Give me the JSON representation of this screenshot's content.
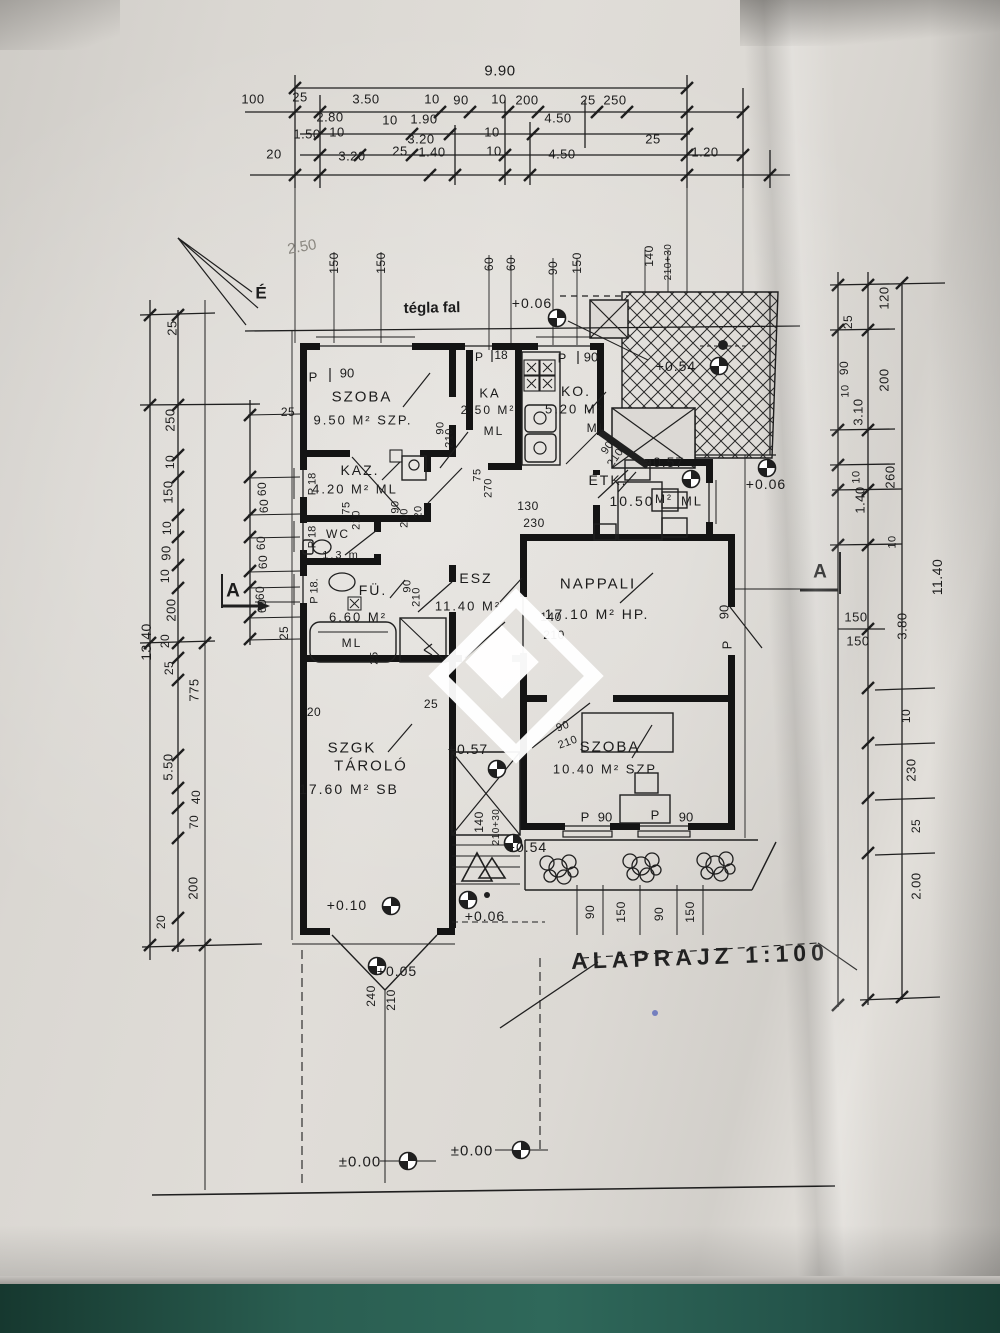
{
  "document": {
    "type": "architectural floor plan photo",
    "title": "ALAPRAJZ  1:100",
    "scale": "1:100",
    "north_label": "É",
    "wall_note": "tégla fal",
    "pencil_note": "2.50",
    "section_marker_left": "A",
    "section_marker_right": "A"
  },
  "rooms": [
    {
      "name": "SZOBA",
      "area": "9.50 M²",
      "suffix": "SZP."
    },
    {
      "name": "KAZ.",
      "area": "4.20 M²",
      "suffix": "ML"
    },
    {
      "name": "KA",
      "area": "2.50 M²",
      "suffix": "ML"
    },
    {
      "name": "KO.",
      "area": "5.20 M²",
      "suffix": "ML"
    },
    {
      "name": "ÉTK.",
      "area": "10.50 M²",
      "suffix": "ML"
    },
    {
      "name": "WC",
      "area": "1.3 m",
      "suffix": ""
    },
    {
      "name": "FÜ.",
      "area": "6.60 M²",
      "suffix": "ML"
    },
    {
      "name": "ESZ",
      "area": "11.40 M²",
      "suffix": ""
    },
    {
      "name": "NAPPALI",
      "area": "17.10 M²",
      "suffix": "HP."
    },
    {
      "name": "SZOBA",
      "area": "10.40 M²",
      "suffix": "SZP"
    },
    {
      "name": "SZGK TÁROLÓ",
      "area": "17.60 M²",
      "suffix": "SB"
    }
  ],
  "elevation_marks": [
    "+0.06",
    "+0.54",
    "+0.57",
    "+0.06",
    "+0.57",
    "+0.54",
    "+0.10",
    "+0.06",
    "+0.05",
    "±0.00",
    "±0.00"
  ],
  "totals": {
    "top": "9.90",
    "left": "13.40",
    "right": "11.40"
  },
  "annotations": [
    [
      "9.90",
      500,
      71,
      0,
      15,
      "d"
    ],
    [
      "100",
      253,
      99,
      0,
      13,
      "d"
    ],
    [
      "25",
      300,
      97,
      0,
      13,
      "d"
    ],
    [
      "3.50",
      366,
      99,
      0,
      13,
      "d"
    ],
    [
      "10",
      432,
      99,
      0,
      13,
      "d"
    ],
    [
      "90",
      461,
      100,
      0,
      13,
      "d"
    ],
    [
      "10",
      499,
      99,
      0,
      13,
      "d"
    ],
    [
      "200",
      527,
      100,
      0,
      13,
      "d"
    ],
    [
      "25",
      588,
      100,
      0,
      13,
      "d"
    ],
    [
      "250",
      615,
      100,
      0,
      13,
      "d"
    ],
    [
      "2.80",
      330,
      117,
      0,
      13,
      "d"
    ],
    [
      "10",
      390,
      120,
      0,
      13,
      "d"
    ],
    [
      "1.90",
      424,
      119,
      0,
      13,
      "d"
    ],
    [
      "4.50",
      558,
      118,
      0,
      13,
      "d"
    ],
    [
      "1.50",
      307,
      134,
      0,
      13,
      "d"
    ],
    [
      "10",
      337,
      132,
      0,
      13,
      "d"
    ],
    [
      "3.20",
      421,
      139,
      0,
      13,
      "d"
    ],
    [
      "10",
      492,
      132,
      0,
      13,
      "d"
    ],
    [
      "25",
      653,
      139,
      0,
      13,
      "d"
    ],
    [
      "20",
      274,
      154,
      0,
      13,
      "d"
    ],
    [
      "3.20",
      352,
      156,
      0,
      13,
      "d"
    ],
    [
      "25",
      400,
      151,
      0,
      13,
      "d"
    ],
    [
      "1.40",
      432,
      152,
      0,
      13,
      "d"
    ],
    [
      "10",
      494,
      151,
      0,
      13,
      "d"
    ],
    [
      "4.50",
      562,
      154,
      0,
      13,
      "d"
    ],
    [
      "1.20",
      705,
      152,
      0,
      13,
      "d"
    ],
    [
      "150",
      334,
      263,
      -90,
      12,
      "d"
    ],
    [
      "150",
      381,
      263,
      -90,
      12,
      "d"
    ],
    [
      "60",
      489,
      264,
      -90,
      12,
      "d"
    ],
    [
      "60",
      511,
      264,
      -90,
      12,
      "d"
    ],
    [
      "90",
      553,
      268,
      -90,
      12,
      "d"
    ],
    [
      "150",
      577,
      263,
      -90,
      12,
      "d"
    ],
    [
      "140",
      649,
      256,
      -90,
      12,
      "d"
    ],
    [
      "210+30",
      669,
      262,
      -90,
      10,
      "d"
    ],
    [
      "2.50",
      302,
      247,
      -10,
      15,
      "p"
    ],
    [
      "25",
      172,
      328,
      -90,
      13,
      "d"
    ],
    [
      "250",
      170,
      420,
      -90,
      13,
      "d"
    ],
    [
      "10",
      170,
      462,
      -90,
      12,
      "d"
    ],
    [
      "150",
      168,
      492,
      -90,
      13,
      "d"
    ],
    [
      "10",
      167,
      528,
      -90,
      12,
      "d"
    ],
    [
      "90",
      166,
      553,
      -90,
      13,
      "d"
    ],
    [
      "10",
      165,
      576,
      -90,
      12,
      "d"
    ],
    [
      "200",
      171,
      610,
      -90,
      13,
      "d"
    ],
    [
      "20",
      165,
      641,
      -90,
      12,
      "d"
    ],
    [
      "25",
      169,
      668,
      -90,
      12,
      "d"
    ],
    [
      "775",
      194,
      690,
      -90,
      13,
      "d"
    ],
    [
      "5.50",
      168,
      767,
      -90,
      13,
      "d"
    ],
    [
      "40",
      196,
      797,
      -90,
      12,
      "d"
    ],
    [
      "70",
      194,
      822,
      -90,
      12,
      "d"
    ],
    [
      "200",
      193,
      888,
      -90,
      13,
      "d"
    ],
    [
      "20",
      161,
      922,
      -90,
      12,
      "d"
    ],
    [
      "13.40",
      146,
      642,
      -90,
      14,
      "d"
    ],
    [
      "25",
      288,
      412,
      0,
      12,
      "d"
    ],
    [
      "60",
      262,
      489,
      -90,
      12,
      "d"
    ],
    [
      "60",
      264,
      506,
      -90,
      12,
      "d"
    ],
    [
      "60",
      261,
      543,
      -90,
      12,
      "d"
    ],
    [
      "60",
      263,
      562,
      -90,
      12,
      "d"
    ],
    [
      "60",
      260,
      593,
      -90,
      12,
      "d"
    ],
    [
      "60",
      262,
      606,
      -90,
      12,
      "d"
    ],
    [
      "25",
      284,
      633,
      -90,
      12,
      "d"
    ],
    [
      "120",
      884,
      298,
      -90,
      13,
      "d"
    ],
    [
      "25",
      848,
      322,
      -90,
      12,
      "d"
    ],
    [
      "200",
      884,
      380,
      -90,
      13,
      "d"
    ],
    [
      "90",
      844,
      368,
      -90,
      12,
      "d"
    ],
    [
      "10",
      846,
      391,
      -90,
      11,
      "d"
    ],
    [
      "3.10",
      858,
      412,
      -90,
      13,
      "d"
    ],
    [
      "10",
      857,
      477,
      -90,
      11,
      "d"
    ],
    [
      "260",
      890,
      477,
      -90,
      13,
      "d"
    ],
    [
      "1.40",
      860,
      500,
      -90,
      13,
      "d"
    ],
    [
      "10",
      893,
      542,
      -90,
      11,
      "d"
    ],
    [
      "11.40",
      937,
      577,
      -90,
      14,
      "d"
    ],
    [
      "150",
      856,
      617,
      0,
      13,
      "d"
    ],
    [
      "150",
      858,
      641,
      0,
      13,
      "d"
    ],
    [
      "3.80",
      902,
      626,
      -90,
      13,
      "d"
    ],
    [
      "10",
      906,
      716,
      -90,
      12,
      "d"
    ],
    [
      "230",
      911,
      770,
      -90,
      13,
      "d"
    ],
    [
      "25",
      916,
      826,
      -90,
      12,
      "d"
    ],
    [
      "2.00",
      916,
      886,
      -90,
      13,
      "d"
    ],
    [
      "tégla fal",
      432,
      308,
      -1,
      15,
      "h"
    ],
    [
      "É",
      261,
      293,
      0,
      17,
      "h"
    ],
    [
      "+0.06",
      532,
      303,
      0,
      14,
      "e"
    ],
    [
      "+0.54",
      676,
      366,
      0,
      14,
      "e"
    ],
    [
      "+0.57",
      664,
      462,
      0,
      14,
      "e"
    ],
    [
      "+0.06",
      766,
      484,
      0,
      14,
      "e"
    ],
    [
      "+0.57",
      468,
      749,
      0,
      14,
      "e"
    ],
    [
      "+0.54",
      527,
      847,
      0,
      14,
      "e"
    ],
    [
      "+0.10",
      347,
      905,
      0,
      14,
      "e"
    ],
    [
      "+0.06",
      485,
      916,
      0,
      14,
      "e"
    ],
    [
      "+0.05",
      397,
      971,
      0,
      14,
      "e"
    ],
    [
      "±0.00",
      360,
      1162,
      0,
      15,
      "e"
    ],
    [
      "±0.00",
      472,
      1151,
      0,
      15,
      "e"
    ],
    [
      "P",
      313,
      377,
      0,
      13,
      "w"
    ],
    [
      "90",
      347,
      373,
      0,
      13,
      "w"
    ],
    [
      "P",
      479,
      357,
      0,
      12,
      "w"
    ],
    [
      "18",
      501,
      355,
      0,
      12,
      "w"
    ],
    [
      "P",
      562,
      358,
      0,
      13,
      "w"
    ],
    [
      "90",
      591,
      357,
      0,
      13,
      "w"
    ],
    [
      "P 18",
      313,
      484,
      -90,
      11,
      "w"
    ],
    [
      "P 18",
      313,
      537,
      -90,
      11,
      "w"
    ],
    [
      "P 18.",
      315,
      591,
      -90,
      11,
      "w"
    ],
    [
      "SZOBA",
      362,
      397,
      0,
      15,
      "r"
    ],
    [
      "9.50 M² SZP.",
      363,
      420,
      0,
      13,
      "r"
    ],
    [
      "KAZ.",
      360,
      470,
      0,
      14,
      "r"
    ],
    [
      "4.20 M² ML",
      355,
      489,
      0,
      13,
      "r"
    ],
    [
      "WC",
      338,
      534,
      0,
      12,
      "r"
    ],
    [
      "1.3 m",
      341,
      556,
      0,
      11,
      "r"
    ],
    [
      "FÜ.",
      373,
      590,
      0,
      14,
      "r"
    ],
    [
      "6.60 M²",
      358,
      617,
      0,
      13,
      "r"
    ],
    [
      "ML",
      352,
      643,
      0,
      12,
      "r"
    ],
    [
      "ESZ",
      476,
      578,
      0,
      14,
      "r"
    ],
    [
      "11.40 M²",
      468,
      606,
      0,
      13,
      "r"
    ],
    [
      "KA",
      490,
      393,
      0,
      13,
      "r"
    ],
    [
      "2.50 M²",
      488,
      410,
      0,
      12,
      "r"
    ],
    [
      "ML",
      494,
      431,
      0,
      12,
      "r"
    ],
    [
      "KO.",
      576,
      391,
      0,
      14,
      "r"
    ],
    [
      "5.20 M²",
      574,
      409,
      0,
      13,
      "r"
    ],
    [
      "ML",
      597,
      428,
      0,
      12,
      "r"
    ],
    [
      "ÉTK.",
      608,
      480,
      0,
      14,
      "r"
    ],
    [
      "10.50",
      632,
      501,
      0,
      14,
      "r"
    ],
    [
      "M²",
      664,
      499,
      0,
      12,
      "r"
    ],
    [
      "ML",
      692,
      501,
      0,
      13,
      "r"
    ],
    [
      "NAPPALI",
      598,
      584,
      0,
      15,
      "r"
    ],
    [
      "17.10 M² HP.",
      597,
      614,
      0,
      14,
      "r"
    ],
    [
      "SZOBA",
      610,
      747,
      0,
      15,
      "r"
    ],
    [
      "10.40 M² SZP",
      605,
      769,
      0,
      13,
      "r"
    ],
    [
      "SZGK",
      352,
      748,
      0,
      15,
      "r"
    ],
    [
      "TÁROLÓ",
      371,
      766,
      0,
      15,
      "r"
    ],
    [
      "17.60 M² SB",
      349,
      789,
      0,
      14,
      "r"
    ],
    [
      "75",
      347,
      508,
      -90,
      11,
      "d"
    ],
    [
      "210",
      357,
      520,
      -90,
      11,
      "d"
    ],
    [
      "90",
      396,
      507,
      -90,
      11,
      "d"
    ],
    [
      "210",
      405,
      518,
      -90,
      11,
      "d"
    ],
    [
      "20",
      419,
      512,
      -90,
      11,
      "d"
    ],
    [
      "90",
      441,
      428,
      -90,
      11,
      "d"
    ],
    [
      "210",
      450,
      438,
      -90,
      11,
      "d"
    ],
    [
      "75",
      478,
      475,
      -90,
      11,
      "d"
    ],
    [
      "270",
      489,
      488,
      -90,
      11,
      "d"
    ],
    [
      "90",
      608,
      448,
      -55,
      11,
      "d"
    ],
    [
      "210",
      616,
      458,
      -55,
      11,
      "d"
    ],
    [
      "90",
      408,
      586,
      -90,
      11,
      "d"
    ],
    [
      "210",
      417,
      597,
      -90,
      11,
      "d"
    ],
    [
      "25",
      375,
      658,
      -90,
      11,
      "d"
    ],
    [
      "90",
      563,
      727,
      -20,
      11,
      "d"
    ],
    [
      "210",
      568,
      743,
      -20,
      11,
      "d"
    ],
    [
      "130",
      528,
      506,
      0,
      12,
      "d"
    ],
    [
      "230",
      534,
      523,
      0,
      12,
      "d"
    ],
    [
      "140",
      551,
      617,
      0,
      12,
      "d"
    ],
    [
      "210",
      554,
      635,
      0,
      12,
      "d"
    ],
    [
      "90",
      724,
      612,
      -90,
      13,
      "w"
    ],
    [
      "P",
      727,
      645,
      -90,
      13,
      "w"
    ],
    [
      "P",
      585,
      817,
      0,
      13,
      "w"
    ],
    [
      "90",
      605,
      817,
      0,
      13,
      "w"
    ],
    [
      "P",
      655,
      815,
      0,
      13,
      "w"
    ],
    [
      "90",
      686,
      817,
      0,
      13,
      "w"
    ],
    [
      "20",
      314,
      712,
      0,
      12,
      "d"
    ],
    [
      "25",
      431,
      704,
      0,
      12,
      "d"
    ],
    [
      "140",
      479,
      822,
      -90,
      12,
      "d"
    ],
    [
      "210+30",
      497,
      827,
      -90,
      10,
      "d"
    ],
    [
      "240",
      371,
      996,
      -90,
      12,
      "d"
    ],
    [
      "210",
      391,
      1000,
      -90,
      12,
      "d"
    ],
    [
      "90",
      590,
      912,
      -90,
      12,
      "d"
    ],
    [
      "150",
      621,
      912,
      -90,
      12,
      "d"
    ],
    [
      "90",
      659,
      914,
      -90,
      12,
      "d"
    ],
    [
      "150",
      690,
      912,
      -90,
      12,
      "d"
    ],
    [
      "A",
      233,
      591,
      0,
      19,
      "h"
    ],
    [
      "A",
      820,
      572,
      0,
      19,
      "h"
    ],
    [
      "ALAPRAJZ  1:100",
      700,
      957,
      -2,
      23,
      "t"
    ]
  ]
}
